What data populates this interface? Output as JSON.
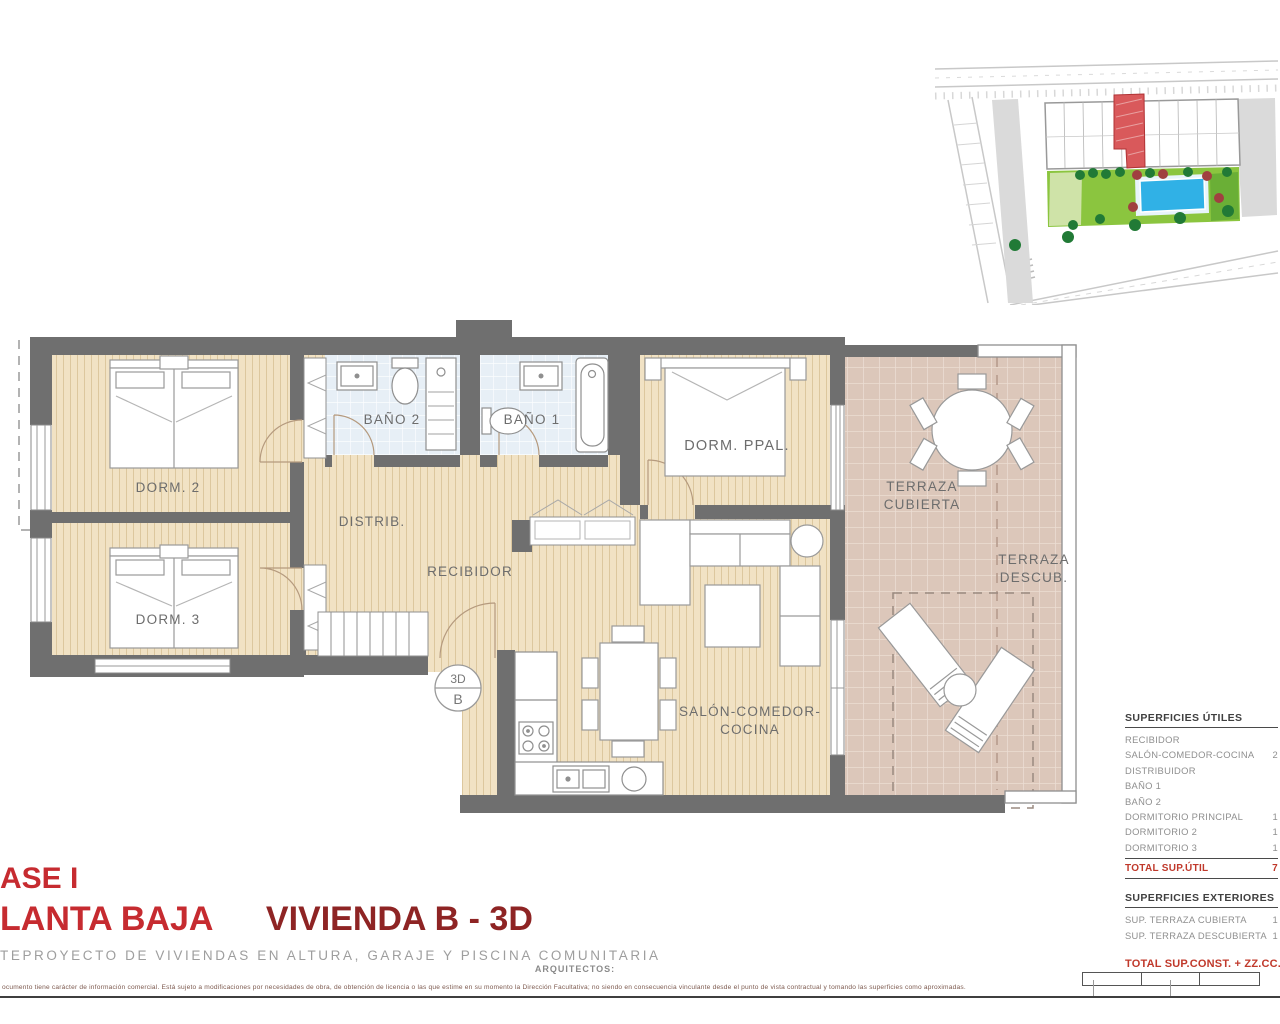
{
  "plan": {
    "labels": {
      "dorm2": "DORM. 2",
      "dorm3": "DORM. 3",
      "bano2": "BAÑO 2",
      "bano1": "BAÑO 1",
      "dorm_ppal": "DORM. PPAL.",
      "distrib": "DISTRIB.",
      "recibidor": "RECIBIDOR",
      "salon_1": "SALÓN-COMEDOR-",
      "salon_2": "COCINA",
      "terraza_cubierta_1": "TERRAZA",
      "terraza_cubierta_2": "CUBIERTA",
      "terraza_descubierta_1": "TERRAZA",
      "terraza_descubierta_2": "DESCUB."
    },
    "marker": {
      "top": "3D",
      "bottom": "B"
    }
  },
  "surfaces_table": {
    "useful_title": "SUPERFICIES ÚTILES",
    "useful_rows": [
      {
        "label": "RECIBIDOR",
        "value": ""
      },
      {
        "label": "SALÓN-COMEDOR-COCINA",
        "value": "2"
      },
      {
        "label": "DISTRIBUIDOR",
        "value": ""
      },
      {
        "label": "BAÑO 1",
        "value": ""
      },
      {
        "label": "BAÑO 2",
        "value": ""
      },
      {
        "label": "DORMITORIO PRINCIPAL",
        "value": "1"
      },
      {
        "label": "DORMITORIO 2",
        "value": "1"
      },
      {
        "label": "DORMITORIO 3",
        "value": "1"
      }
    ],
    "useful_total": {
      "label": "TOTAL SUP.ÚTIL",
      "value": "7"
    },
    "exterior_title": "SUPERFICIES EXTERIORES",
    "exterior_rows": [
      {
        "label": "SUP. TERRAZA CUBIERTA",
        "value": "1"
      },
      {
        "label": "SUP. TERRAZA DESCUBIERTA",
        "value": "1"
      }
    ],
    "grand_total": {
      "label": "TOTAL SUP.CONST. + ZZ.CC.",
      "value": "121,"
    }
  },
  "titles": {
    "phase": "ASE I",
    "floor": "LANTA BAJA",
    "unit": "VIVIENDA B - 3D",
    "subtitle": "TEPROYECTO DE VIVIENDAS EN ALTURA, GARAJE Y PISCINA COMUNITARIA",
    "architects": "ARQUITECTOS:"
  },
  "scale_bar": {
    "labels": [
      "1",
      "2",
      "3"
    ]
  },
  "disclaimer": "ocumento tiene carácter de información comercial. Está sujeto a modificaciones por necesidades de obra, de obtención de licencia o las que estime en su momento la Dirección Facultativa; no siendo en consecuencia vinculante desde el punto de vista contractual y tomando las superficies como aproximadas.",
  "colors": {
    "title_red": "#c62b30",
    "title_dark_red": "#8e2424",
    "totals_red": "#c0392b",
    "wall_gray": "#6f6f6f",
    "floor_beige": "#f1e2c4",
    "bath_blue": "#e7eff6",
    "terrace_pink": "#dcc7ba",
    "garden_green": "#8bc53f",
    "pool_blue": "#30b1e6",
    "site_highlight": "#d9595b",
    "label_gray": "#6d6d6d"
  }
}
